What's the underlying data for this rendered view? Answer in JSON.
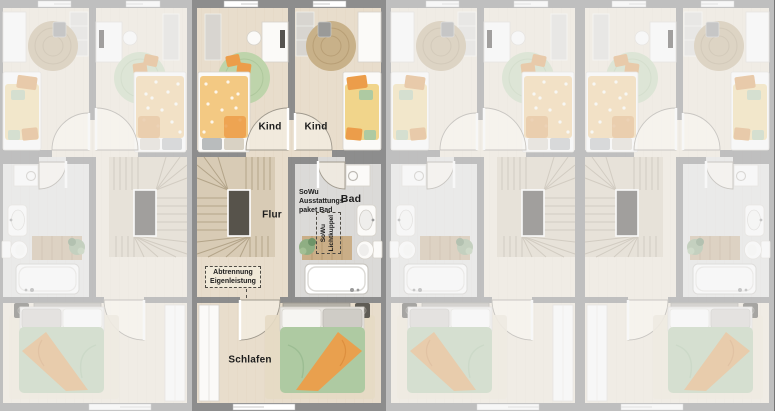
{
  "scene": {
    "description": "Row of four townhouse upper-floor plans, second unit highlighted",
    "selected_unit": "unit-2",
    "unit_count": 4
  },
  "units": [
    {
      "id": "unit-1",
      "state": "dimmed",
      "mirrored": true
    },
    {
      "id": "unit-2",
      "state": "active",
      "mirrored": false
    },
    {
      "id": "unit-3",
      "state": "dimmed",
      "mirrored": true
    },
    {
      "id": "unit-4",
      "state": "dimmed",
      "mirrored": false
    }
  ],
  "labels": {
    "kind_left": "Kind",
    "kind_right": "Kind",
    "flur": "Flur",
    "bad": "Bad",
    "schlafen": "Schlafen",
    "bath_package": [
      "SoWu",
      "Ausstattungs-",
      "paket Bad"
    ],
    "skylight": [
      "SoWu",
      "Lichtkuppel"
    ],
    "partition": [
      "Abtrennung",
      "Eigenleistung"
    ]
  },
  "colors": {
    "wall": "#8d8d8d",
    "canvas_bg": "#767676",
    "floor_wood": "#e8ddcc",
    "floor_bath": "#dbdad8",
    "stair": "#d8cbb5",
    "stair_line": "#b3a489",
    "accent_orange": "#ec9d4a",
    "accent_green": "#aecaa2",
    "rug_green": "#bed4ab",
    "rug_jute": "#c8b189",
    "bed_yellow": "#f1d58b",
    "label_text": "#1c1c1c"
  }
}
